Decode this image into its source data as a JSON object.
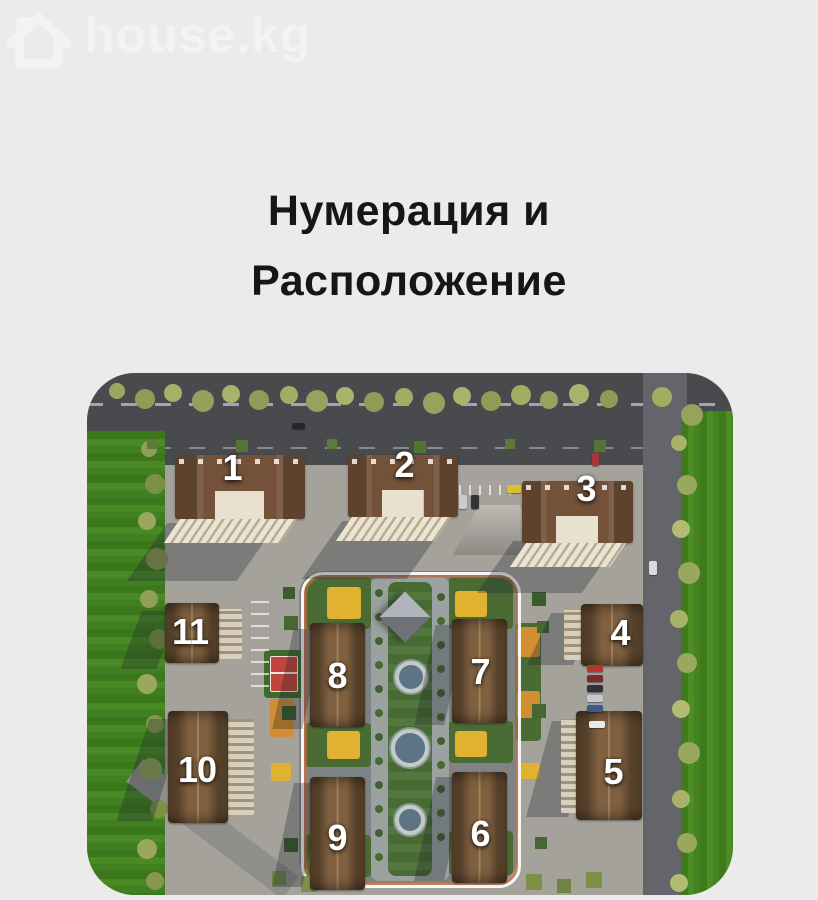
{
  "brand": {
    "name": "house.kg",
    "icon": "house-outline-icon",
    "color": "#f3f3f3"
  },
  "title": {
    "line1": "Нумерация и",
    "line2": "Расположение"
  },
  "site_plan": {
    "type": "residential-complex-aerial-render",
    "description": "3D aerial site plan of a residential complex with numbered buildings",
    "buildings": [
      {
        "label": "1"
      },
      {
        "label": "2"
      },
      {
        "label": "3"
      },
      {
        "label": "4"
      },
      {
        "label": "5"
      },
      {
        "label": "6"
      },
      {
        "label": "7"
      },
      {
        "label": "8"
      },
      {
        "label": "9"
      },
      {
        "label": "10"
      },
      {
        "label": "11"
      }
    ],
    "colors": {
      "grass": "#4a8a24",
      "trees_olive": "#9aa75f",
      "road_dark": "#494a4e",
      "paving": "#a5a29b",
      "roof_brown": "#74523a",
      "facade_cream": "#e9e1cf",
      "court_red": "#c0453c",
      "playground_yellow": "#e0b22f",
      "ring_white": "#ffffff",
      "ring_orange": "#d2703a",
      "number_white": "#ffffff"
    }
  },
  "page": {
    "background": "#ebebeb"
  }
}
